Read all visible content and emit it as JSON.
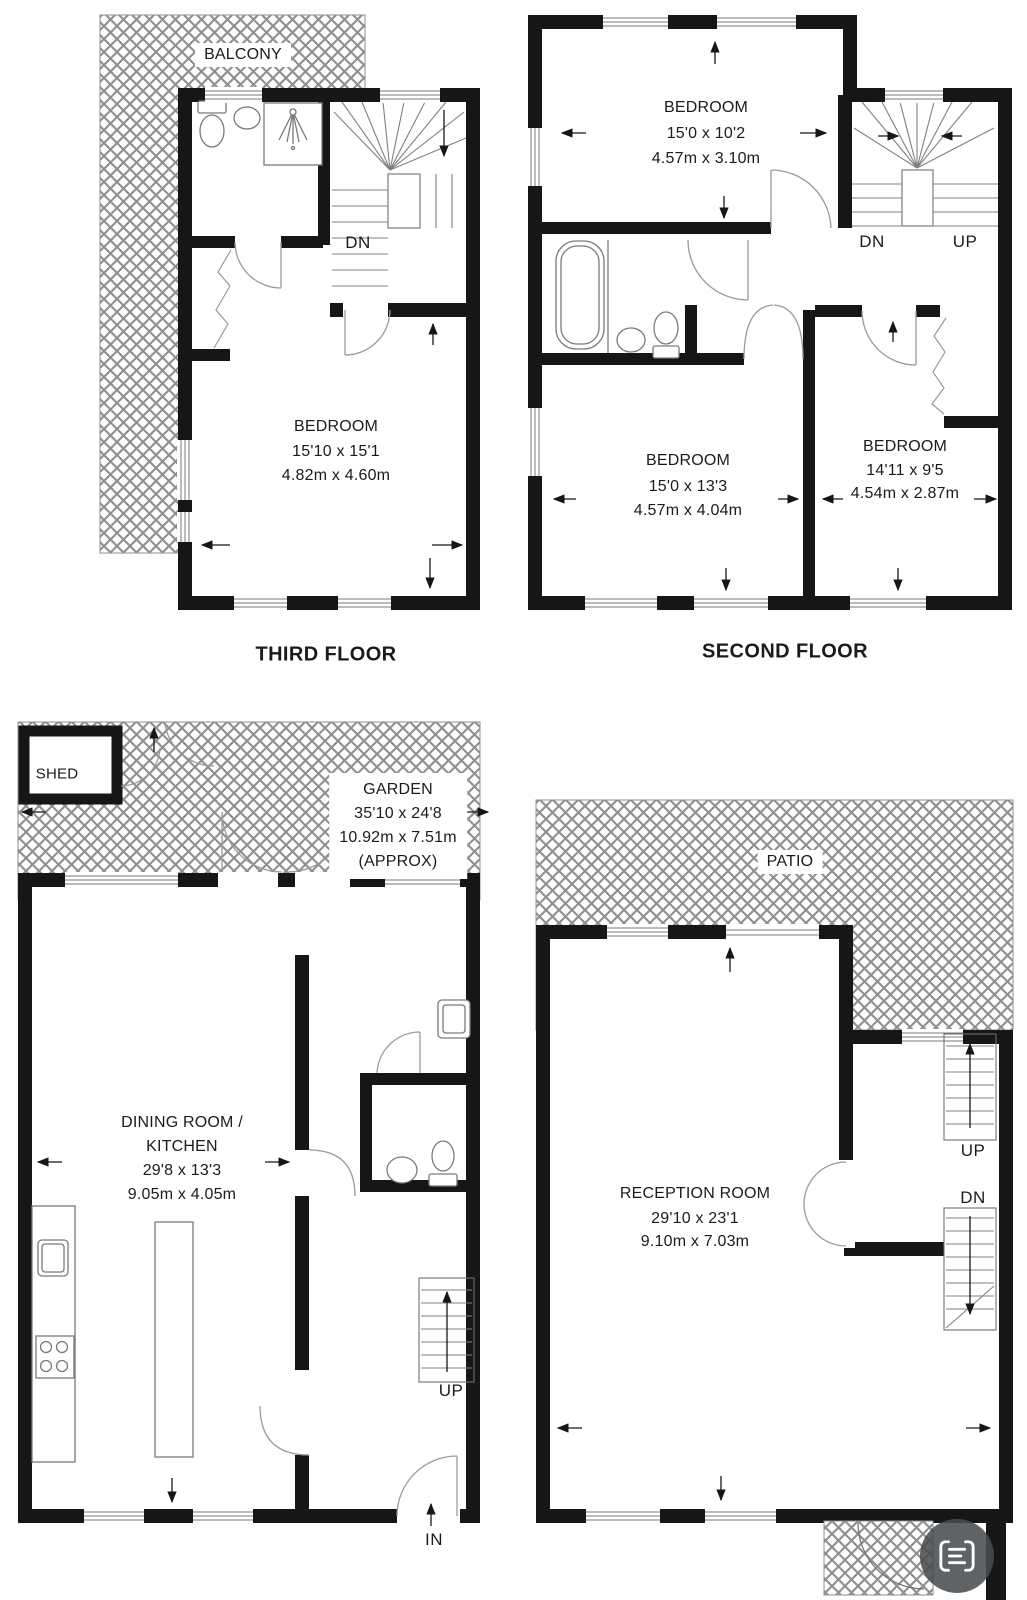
{
  "page": {
    "type": "property-floorplan"
  },
  "colors": {
    "wall": "#161616",
    "hatch_line": "#8f8f8f",
    "fixture_line": "#7a7a7a",
    "door_arc": "#9a9a9a",
    "label_text": "#1b1b1b",
    "scan_button_bg": "#494d50"
  },
  "floors": {
    "third": {
      "title": "THIRD FLOOR",
      "balcony": "BALCONY",
      "stairs_dn": "DN",
      "bedroom": {
        "name": "BEDROOM",
        "imperial": "15'10 x 15'1",
        "metric": "4.82m x 4.60m"
      }
    },
    "second": {
      "title": "SECOND FLOOR",
      "stairs_dn": "DN",
      "stairs_up": "UP",
      "bedroom1": {
        "name": "BEDROOM",
        "imperial": "15'0 x 10'2",
        "metric": "4.57m x 3.10m"
      },
      "bedroom2": {
        "name": "BEDROOM",
        "imperial": "15'0 x 13'3",
        "metric": "4.57m x 4.04m"
      },
      "bedroom3": {
        "name": "BEDROOM",
        "imperial": "14'11 x 9'5",
        "metric": "4.54m x 2.87m"
      }
    },
    "ground_left": {
      "shed": "SHED",
      "stairs_up": "UP",
      "entrance": "IN",
      "garden": {
        "name": "GARDEN",
        "imperial": "35'10 x 24'8",
        "metric": "10.92m x 7.51m",
        "approx": "(APPROX)"
      },
      "dining": {
        "line1": "DINING ROOM /",
        "line2": "KITCHEN",
        "imperial": "29'8 x 13'3",
        "metric": "9.05m x 4.05m"
      }
    },
    "ground_right": {
      "patio": "PATIO",
      "stairs_up": "UP",
      "stairs_dn": "DN",
      "reception": {
        "name": "RECEPTION ROOM",
        "imperial": "29'10 x 23'1",
        "metric": "9.10m x 7.03m"
      }
    }
  },
  "overlay": {
    "scan_button_icon": "scan-text-icon"
  }
}
